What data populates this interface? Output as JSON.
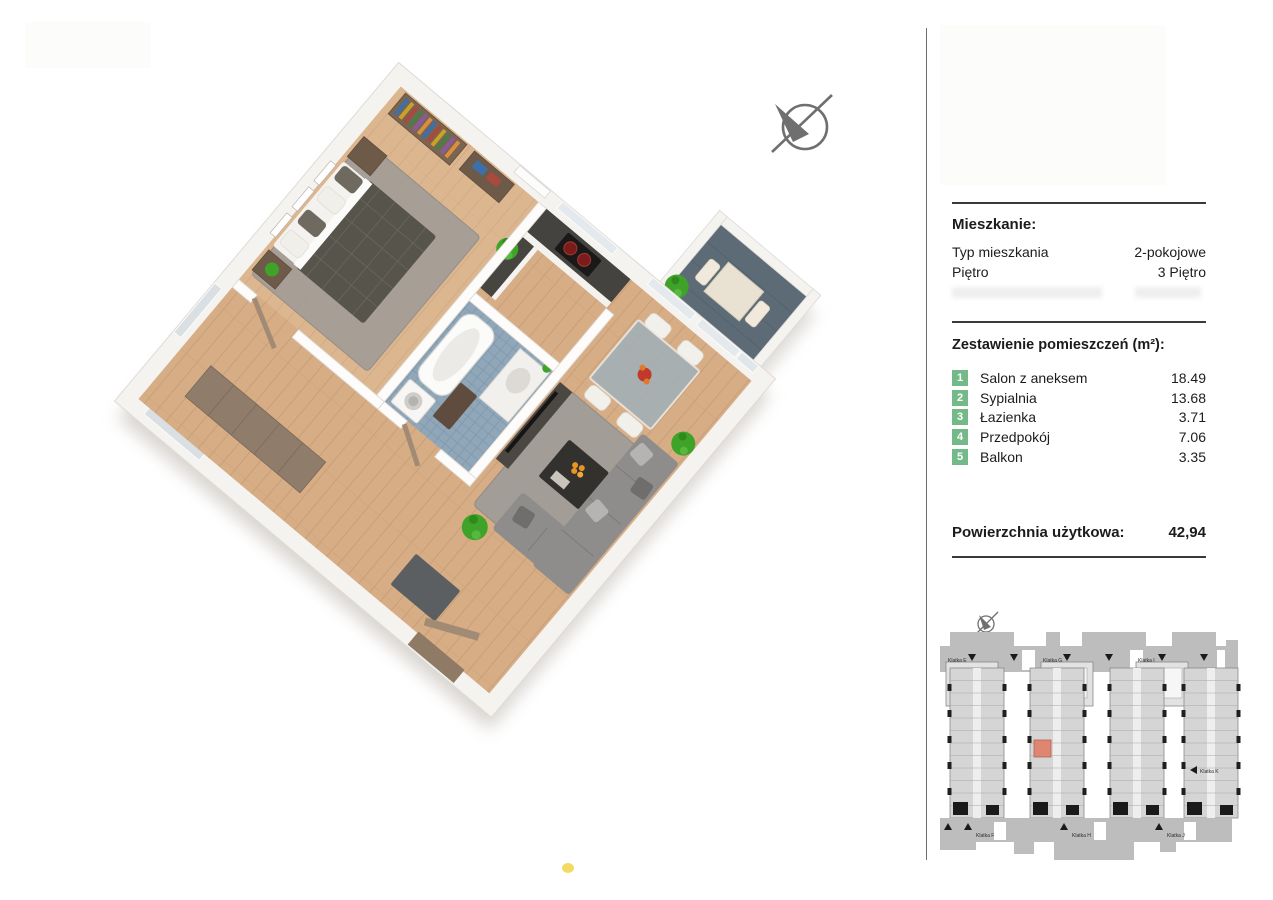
{
  "panel": {
    "apartment": {
      "heading": "Mieszkanie:",
      "rows": [
        {
          "label": "Typ mieszkania",
          "value": "2-pokojowe"
        },
        {
          "label": "Piętro",
          "value": "3 Piętro"
        }
      ]
    },
    "rooms": {
      "heading": "Zestawienie pomieszczeń (m²):",
      "badge_color": "#74ba88",
      "items": [
        {
          "num": "1",
          "name": "Salon z aneksem",
          "area": "18.49"
        },
        {
          "num": "2",
          "name": "Sypialnia",
          "area": "13.68"
        },
        {
          "num": "3",
          "name": "Łazienka",
          "area": "3.71"
        },
        {
          "num": "4",
          "name": "Przedpokój",
          "area": "7.06"
        },
        {
          "num": "5",
          "name": "Balkon",
          "area": "3.35"
        }
      ]
    },
    "total": {
      "label": "Powierzchnia użytkowa:",
      "value": "42,94"
    }
  },
  "floor_plan": {
    "type": "3d-isometric-apartment",
    "rooms": [
      "Salon z aneksem",
      "Sypialnia",
      "Łazienka",
      "Przedpokój",
      "Balkon"
    ],
    "colors": {
      "wood_floor": "#d7ad85",
      "bath_tile": "#8fa7b8",
      "balcony_floor": "#5d6b76",
      "rug": "#a39d97",
      "wall": "#f5f3f0",
      "plant": "#3fa32a"
    }
  },
  "minimap": {
    "labels": {
      "top": [
        "Klatka E",
        "Klatka G",
        "Klatka I"
      ],
      "bottom": [
        "Klatka F",
        "Klatka H",
        "Klatka J"
      ],
      "right": "Klatka K"
    },
    "highlight_color": "#dd8672"
  }
}
